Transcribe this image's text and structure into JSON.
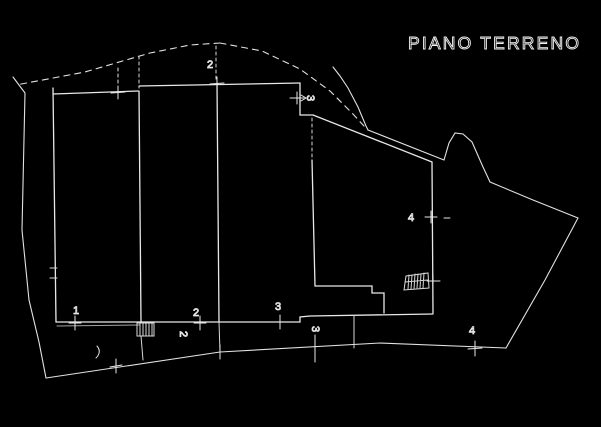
{
  "title": "PIANO TERRENO",
  "colors": {
    "background": "#000000",
    "line": "#e8e8e8"
  },
  "labels": {
    "axis_top_2": "2",
    "axis_top_3": "3",
    "axis_right_4": "4",
    "axis_bottom_1": "1",
    "axis_bottom_2": "2",
    "axis_bottom_2_rotated": "2",
    "axis_bottom_3": "3",
    "axis_bottom_3_rotated": "3",
    "axis_bottom_4": "4"
  }
}
